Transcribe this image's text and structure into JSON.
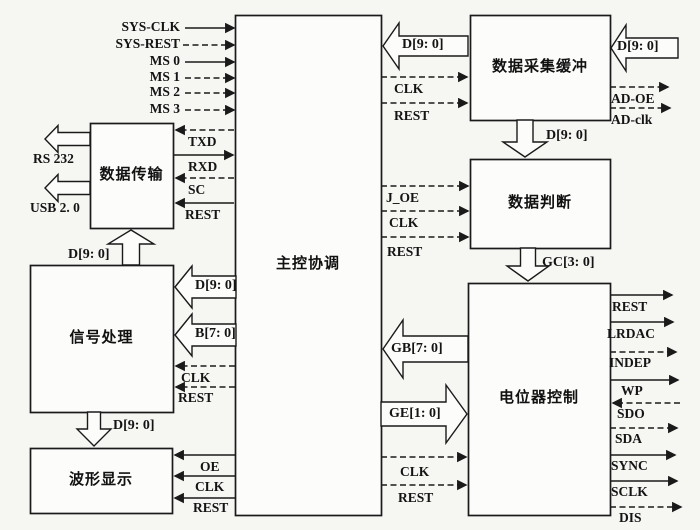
{
  "canvas": {
    "w": 700,
    "h": 530,
    "bg": "#f6f6f3",
    "ink": "#1a1a1a",
    "box_fill": "#fcfcfa"
  },
  "boxes": [
    {
      "id": "main-control",
      "label": "主控协调",
      "x": 235,
      "y": 15,
      "w": 146,
      "h": 500
    },
    {
      "id": "data-transfer",
      "label": "数据传输",
      "x": 90,
      "y": 123,
      "w": 83,
      "h": 105
    },
    {
      "id": "signal-processing",
      "label": "信号处理",
      "x": 30,
      "y": 265,
      "w": 143,
      "h": 147
    },
    {
      "id": "waveform-display",
      "label": "波形显示",
      "x": 30,
      "y": 448,
      "w": 142,
      "h": 65
    },
    {
      "id": "data-acquisition-buffer",
      "label": "数据采集缓冲",
      "x": 470,
      "y": 15,
      "w": 140,
      "h": 105
    },
    {
      "id": "data-judgment",
      "label": "数据判断",
      "x": 470,
      "y": 159,
      "w": 140,
      "h": 89
    },
    {
      "id": "potentiometer-control",
      "label": "电位器控制",
      "x": 468,
      "y": 283,
      "w": 142,
      "h": 232
    }
  ],
  "lines": [
    {
      "id": "sys-clk",
      "label": "SYS-CLK",
      "tail": 185,
      "head": 234,
      "y": 28,
      "dashed": false,
      "lx": 180,
      "ly": 20,
      "align": "right"
    },
    {
      "id": "sys-rest",
      "label": "SYS-REST",
      "tail": 183,
      "head": 234,
      "y": 45,
      "dashed": true,
      "lx": 180,
      "ly": 37,
      "align": "right"
    },
    {
      "id": "ms0",
      "label": "MS 0",
      "tail": 185,
      "head": 234,
      "y": 62,
      "dashed": false,
      "lx": 180,
      "ly": 54,
      "align": "right"
    },
    {
      "id": "ms1",
      "label": "MS 1",
      "tail": 185,
      "head": 234,
      "y": 78,
      "dashed": true,
      "lx": 180,
      "ly": 70,
      "align": "right"
    },
    {
      "id": "ms2",
      "label": "MS 2",
      "tail": 185,
      "head": 234,
      "y": 93,
      "dashed": true,
      "lx": 180,
      "ly": 85,
      "align": "right"
    },
    {
      "id": "ms3",
      "label": "MS 3",
      "tail": 185,
      "head": 234,
      "y": 110,
      "dashed": true,
      "lx": 180,
      "ly": 102,
      "align": "right"
    },
    {
      "id": "txd",
      "label": "TXD",
      "tail": 234,
      "head": 176,
      "y": 130,
      "dashed": true,
      "lx": 188,
      "ly": 135,
      "align": "left"
    },
    {
      "id": "rxd",
      "label": "RXD",
      "tail": 174,
      "head": 233,
      "y": 155,
      "dashed": false,
      "lx": 188,
      "ly": 160,
      "align": "left"
    },
    {
      "id": "sc",
      "label": "SC",
      "tail": 234,
      "head": 176,
      "y": 178,
      "dashed": true,
      "lx": 188,
      "ly": 183,
      "align": "left"
    },
    {
      "id": "rest-dt",
      "label": "REST",
      "tail": 234,
      "head": 176,
      "y": 203,
      "dashed": false,
      "lx": 185,
      "ly": 208,
      "align": "left"
    },
    {
      "id": "clk-sp",
      "label": "CLK",
      "tail": 235,
      "head": 176,
      "y": 366,
      "dashed": true,
      "lx": 181,
      "ly": 371,
      "align": "left"
    },
    {
      "id": "rest-sp",
      "label": "REST",
      "tail": 235,
      "head": 176,
      "y": 387,
      "dashed": true,
      "lx": 178,
      "ly": 391,
      "align": "left"
    },
    {
      "id": "oe-wd",
      "label": "OE",
      "tail": 235,
      "head": 175,
      "y": 455,
      "dashed": false,
      "lx": 200,
      "ly": 460,
      "align": "left"
    },
    {
      "id": "clk-wd",
      "label": "CLK",
      "tail": 235,
      "head": 175,
      "y": 476,
      "dashed": false,
      "lx": 195,
      "ly": 480,
      "align": "left"
    },
    {
      "id": "rest-wd",
      "label": "REST",
      "tail": 235,
      "head": 175,
      "y": 498,
      "dashed": false,
      "lx": 193,
      "ly": 501,
      "align": "left"
    },
    {
      "id": "clk-daq",
      "label": "CLK",
      "tail": 381,
      "head": 467,
      "y": 77,
      "dashed": true,
      "lx": 394,
      "ly": 82,
      "align": "left"
    },
    {
      "id": "rest-daq",
      "label": "REST",
      "tail": 381,
      "head": 467,
      "y": 103,
      "dashed": true,
      "lx": 394,
      "ly": 109,
      "align": "left"
    },
    {
      "id": "ad-oe",
      "label": "AD-OE",
      "tail": 610,
      "head": 668,
      "y": 87,
      "dashed": true,
      "lx": 611,
      "ly": 92,
      "align": "left"
    },
    {
      "id": "ad-clk",
      "label": "AD-clk",
      "tail": 610,
      "head": 670,
      "y": 108,
      "dashed": true,
      "lx": 611,
      "ly": 113,
      "align": "left"
    },
    {
      "id": "j-oe",
      "label": "J_OE",
      "tail": 381,
      "head": 468,
      "y": 186,
      "dashed": true,
      "lx": 386,
      "ly": 191,
      "align": "left"
    },
    {
      "id": "clk-dj",
      "label": "CLK",
      "tail": 381,
      "head": 468,
      "y": 211,
      "dashed": true,
      "lx": 389,
      "ly": 216,
      "align": "left"
    },
    {
      "id": "rest-dj",
      "label": "REST",
      "tail": 381,
      "head": 468,
      "y": 237,
      "dashed": true,
      "lx": 387,
      "ly": 245,
      "align": "left"
    },
    {
      "id": "clk-pc",
      "label": "CLK",
      "tail": 381,
      "head": 466,
      "y": 457,
      "dashed": true,
      "lx": 400,
      "ly": 465,
      "align": "left"
    },
    {
      "id": "rest-pc",
      "label": "REST",
      "tail": 381,
      "head": 466,
      "y": 485,
      "dashed": true,
      "lx": 398,
      "ly": 491,
      "align": "left"
    },
    {
      "id": "rest-out",
      "label": "REST",
      "tail": 610,
      "head": 672,
      "y": 295,
      "dashed": false,
      "lx": 612,
      "ly": 300,
      "align": "left"
    },
    {
      "id": "lrdac",
      "label": "LRDAC",
      "tail": 610,
      "head": 673,
      "y": 322,
      "dashed": false,
      "lx": 607,
      "ly": 327,
      "align": "left"
    },
    {
      "id": "indep",
      "label": "INDEP",
      "tail": 610,
      "head": 676,
      "y": 352,
      "dashed": true,
      "lx": 609,
      "ly": 356,
      "align": "left"
    },
    {
      "id": "wp",
      "label": "WP",
      "tail": 610,
      "head": 678,
      "y": 380,
      "dashed": false,
      "lx": 621,
      "ly": 384,
      "align": "left"
    },
    {
      "id": "sdo",
      "label": "SDO",
      "tail": 680,
      "head": 613,
      "y": 403,
      "dashed": true,
      "lx": 617,
      "ly": 407,
      "align": "left"
    },
    {
      "id": "sda",
      "label": "SDA",
      "tail": 610,
      "head": 677,
      "y": 428,
      "dashed": true,
      "lx": 615,
      "ly": 432,
      "align": "left"
    },
    {
      "id": "sync",
      "label": "SYNC",
      "tail": 610,
      "head": 675,
      "y": 455,
      "dashed": false,
      "lx": 611,
      "ly": 459,
      "align": "left"
    },
    {
      "id": "sclk",
      "label": "SCLK",
      "tail": 610,
      "head": 677,
      "y": 481,
      "dashed": false,
      "lx": 611,
      "ly": 485,
      "align": "left"
    },
    {
      "id": "dis",
      "label": "DIS",
      "tail": 610,
      "head": 681,
      "y": 507,
      "dashed": true,
      "lx": 619,
      "ly": 511,
      "align": "left"
    }
  ],
  "bus_arrows": [
    {
      "id": "d90-to-signal",
      "label": "D[9: 0]",
      "dir": "left",
      "tip": [
        175,
        287
      ],
      "hl": 17,
      "hw": 42,
      "bl": 44,
      "bw": 22,
      "lx": 195,
      "ly": 279
    },
    {
      "id": "b70-to-signal",
      "label": "B[7: 0]",
      "dir": "left",
      "tip": [
        175,
        335
      ],
      "hl": 17,
      "hw": 42,
      "bl": 44,
      "bw": 22,
      "lx": 195,
      "ly": 327
    },
    {
      "id": "d90-to-main",
      "label": "D[9: 0]",
      "dir": "left",
      "tip": [
        383,
        46
      ],
      "hl": 16,
      "hw": 46,
      "bl": 69,
      "bw": 20,
      "lx": 402,
      "ly": 38
    },
    {
      "id": "d90-adc-input",
      "label": "D[9: 0]",
      "dir": "left",
      "tip": [
        611,
        48
      ],
      "hl": 15,
      "hw": 46,
      "bl": 52,
      "bw": 20,
      "lx": 617,
      "ly": 40
    },
    {
      "id": "d90-to-judge",
      "label": "D[9: 0]",
      "dir": "down",
      "tip": [
        525,
        157
      ],
      "hl": 15,
      "hw": 44,
      "bl": 22,
      "bw": 16,
      "lx": 546,
      "ly": 129
    },
    {
      "id": "gc30-to-pot",
      "label": "GC[3: 0]",
      "dir": "down",
      "tip": [
        528,
        281
      ],
      "hl": 15,
      "hw": 42,
      "bl": 18,
      "bw": 15,
      "lx": 542,
      "ly": 256
    },
    {
      "id": "gb70-to-main",
      "label": "GB[7: 0]",
      "dir": "left",
      "tip": [
        383,
        349
      ],
      "hl": 20,
      "hw": 58,
      "bl": 65,
      "bw": 26,
      "lx": 391,
      "ly": 342
    },
    {
      "id": "ge10-to-pot",
      "label": "GE[1: 0]",
      "dir": "right",
      "tip": [
        467,
        414
      ],
      "hl": 21,
      "hw": 58,
      "bl": 65,
      "bw": 24,
      "lx": 389,
      "ly": 407
    },
    {
      "id": "d90-to-wave",
      "label": "D[9: 0]",
      "dir": "down",
      "tip": [
        94,
        446
      ],
      "hl": 17,
      "hw": 34,
      "bl": 17,
      "bw": 13,
      "lx": 113,
      "ly": 419
    },
    {
      "id": "d90-to-transfer",
      "label": "D[9: 0]",
      "dir": "up",
      "tip": [
        131,
        230
      ],
      "hl": 14,
      "hw": 46,
      "bl": 21,
      "bw": 17,
      "lx": 68,
      "ly": 248
    },
    {
      "id": "rs232-arrow",
      "label": "",
      "dir": "left",
      "tip": [
        45,
        139
      ],
      "hl": 13,
      "hw": 27,
      "bl": 32,
      "bw": 13,
      "lx": 0,
      "ly": 0
    },
    {
      "id": "usb-arrow",
      "label": "",
      "dir": "left",
      "tip": [
        45,
        188
      ],
      "hl": 13,
      "hw": 27,
      "bl": 32,
      "bw": 13,
      "lx": 0,
      "ly": 0
    }
  ],
  "free_labels": [
    {
      "id": "rs232",
      "text": "RS 232",
      "x": 33,
      "y": 152
    },
    {
      "id": "usb20",
      "text": "USB 2. 0",
      "x": 30,
      "y": 201
    }
  ]
}
